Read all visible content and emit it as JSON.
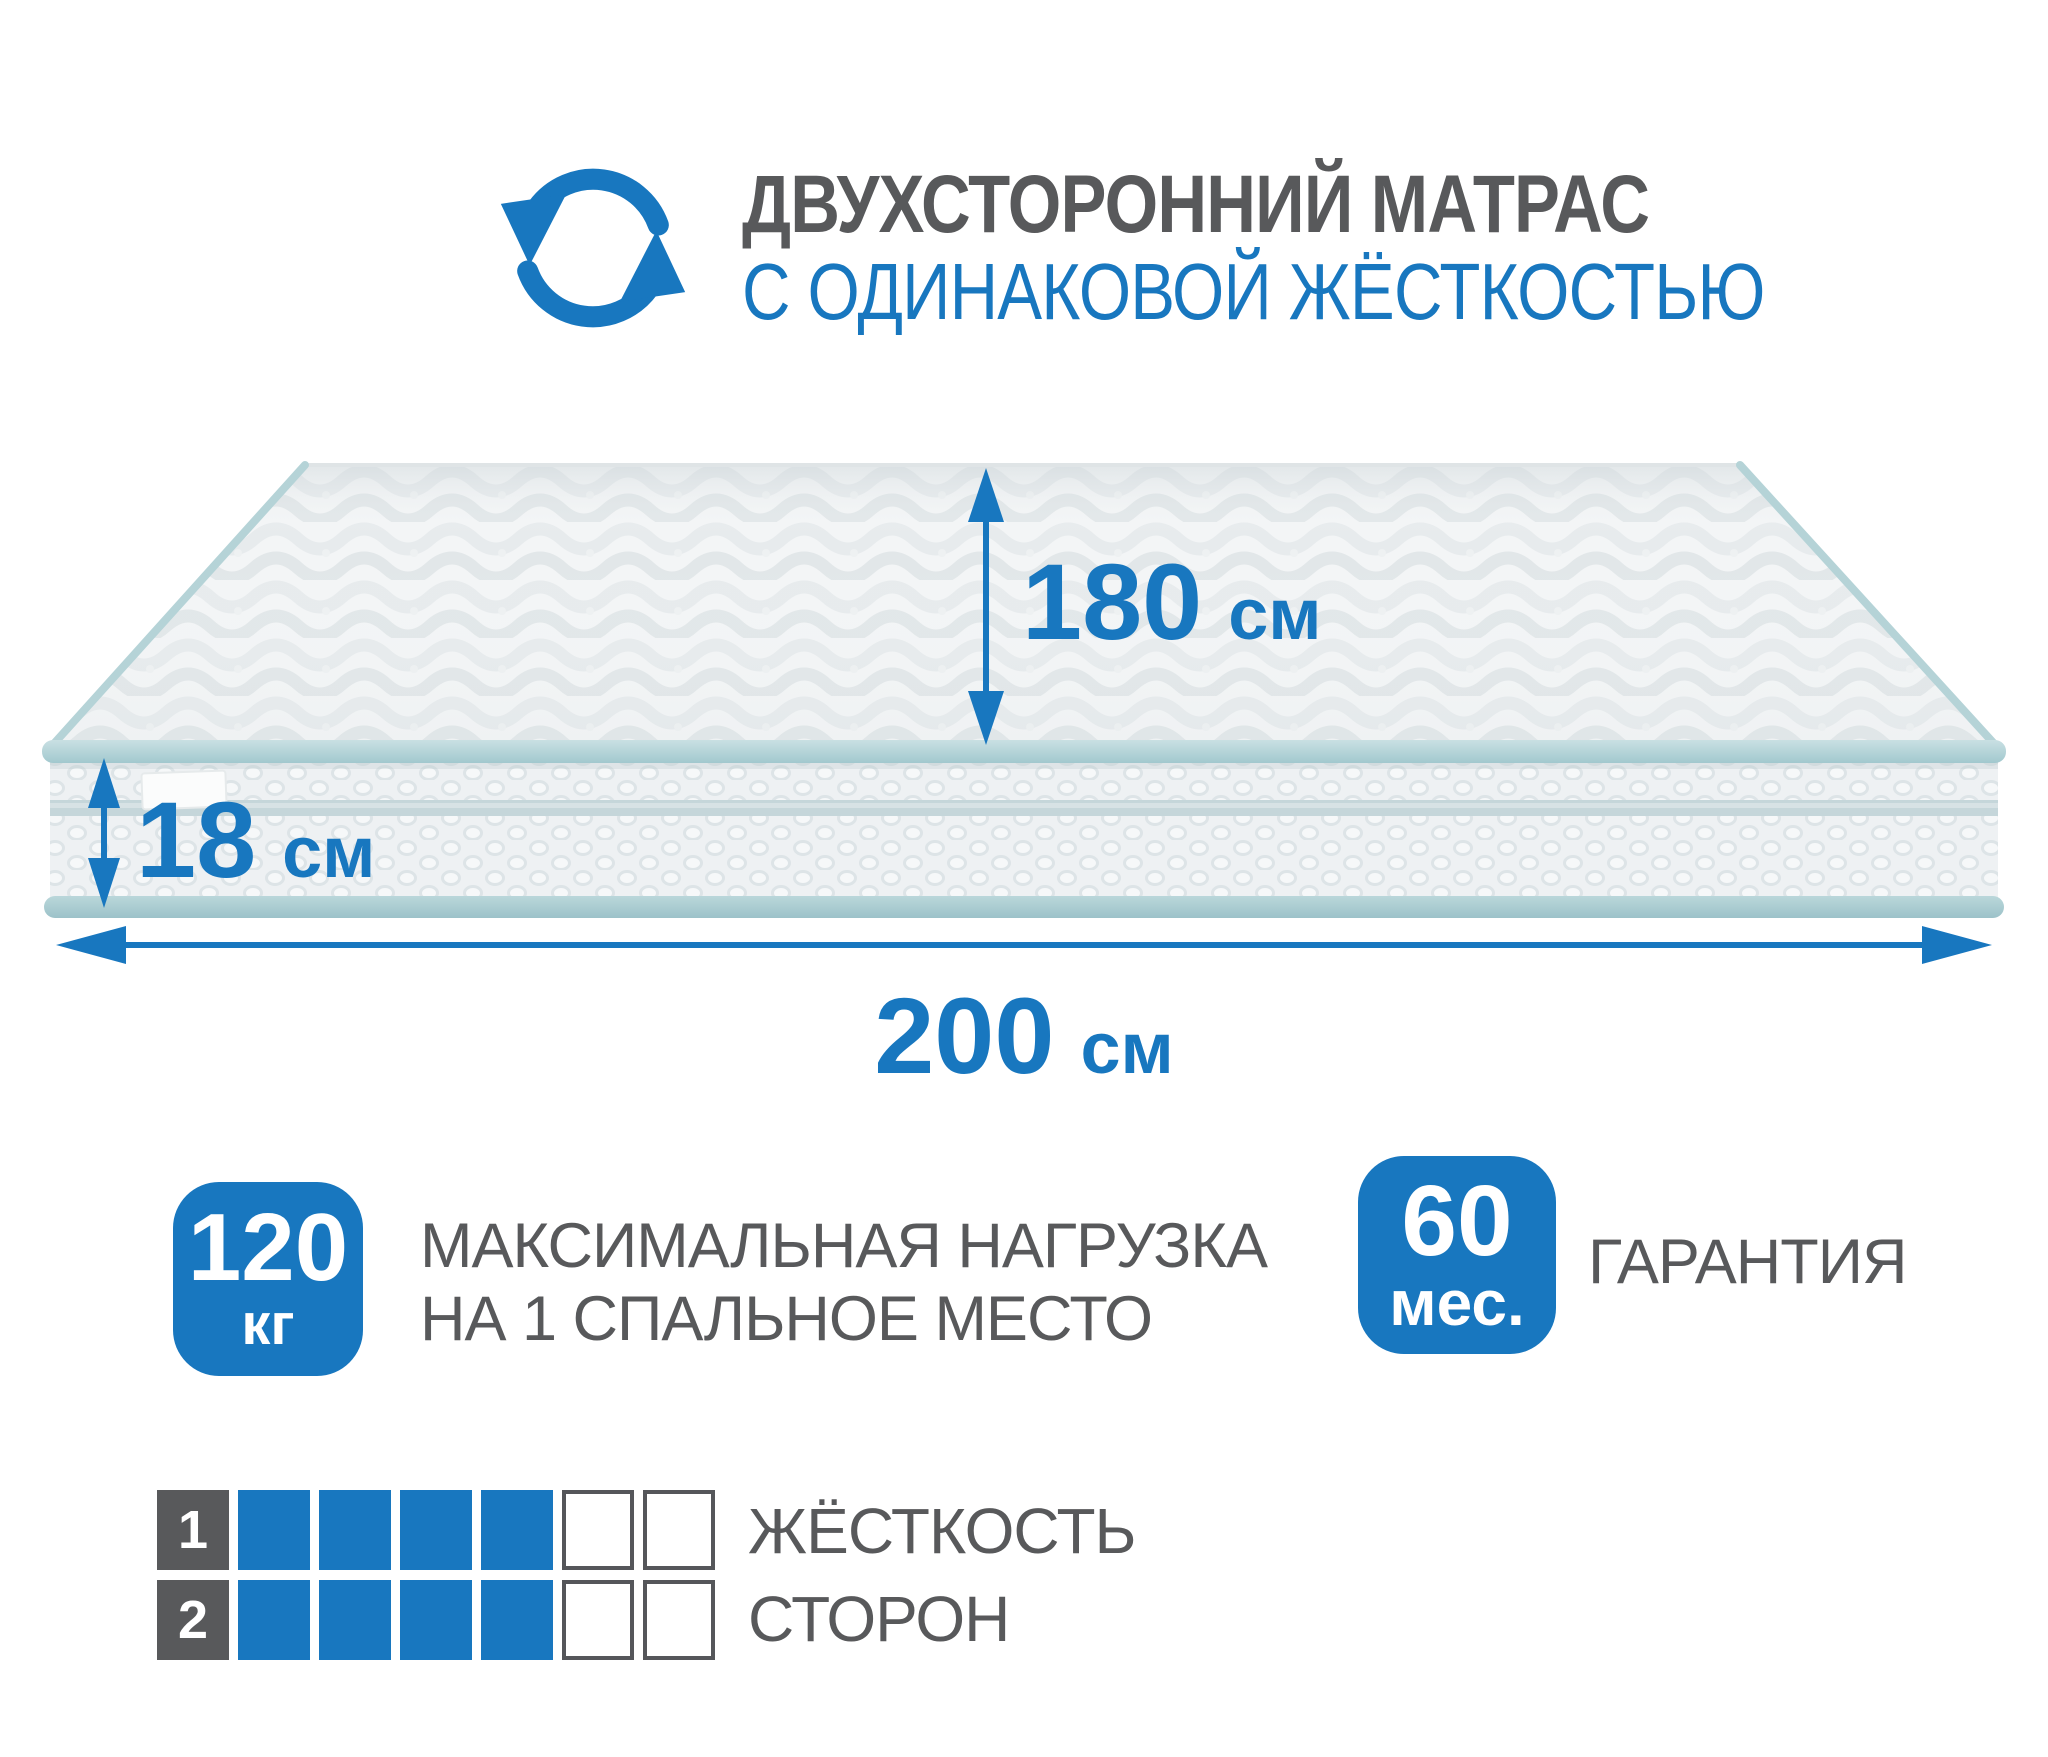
{
  "colors": {
    "accent_blue": "#1877bf",
    "text_gray": "#58595b",
    "piping_teal": "#a9cdd3",
    "side_stripe": "#c5d6da"
  },
  "icons": {
    "header_icon": "rotate-arrows-icon"
  },
  "header": {
    "title_line1": "ДВУХСТОРОННИЙ МАТРАС",
    "title_line2": "С ОДИНАКОВОЙ ЖЁСТКОСТЬЮ"
  },
  "dimensions": {
    "width": {
      "value": "180",
      "unit": "см"
    },
    "height": {
      "value": "18",
      "unit": "см"
    },
    "length": {
      "value": "200",
      "unit": "см"
    }
  },
  "badges": {
    "max_load": {
      "value": "120",
      "unit": "кг",
      "label_line1": "МАКСИМАЛЬНАЯ НАГРУЗКА",
      "label_line2": "НА 1 СПАЛЬНОЕ МЕСТО"
    },
    "warranty": {
      "value": "60",
      "unit": "мес.",
      "label": "ГАРАНТИЯ"
    }
  },
  "firmness": {
    "label_line1": "ЖЁСТКОСТЬ",
    "label_line2": "СТОРОН",
    "rows": [
      {
        "number": "1",
        "cells": [
          1,
          1,
          1,
          1,
          0,
          0
        ]
      },
      {
        "number": "2",
        "cells": [
          1,
          1,
          1,
          1,
          0,
          0
        ]
      }
    ]
  }
}
